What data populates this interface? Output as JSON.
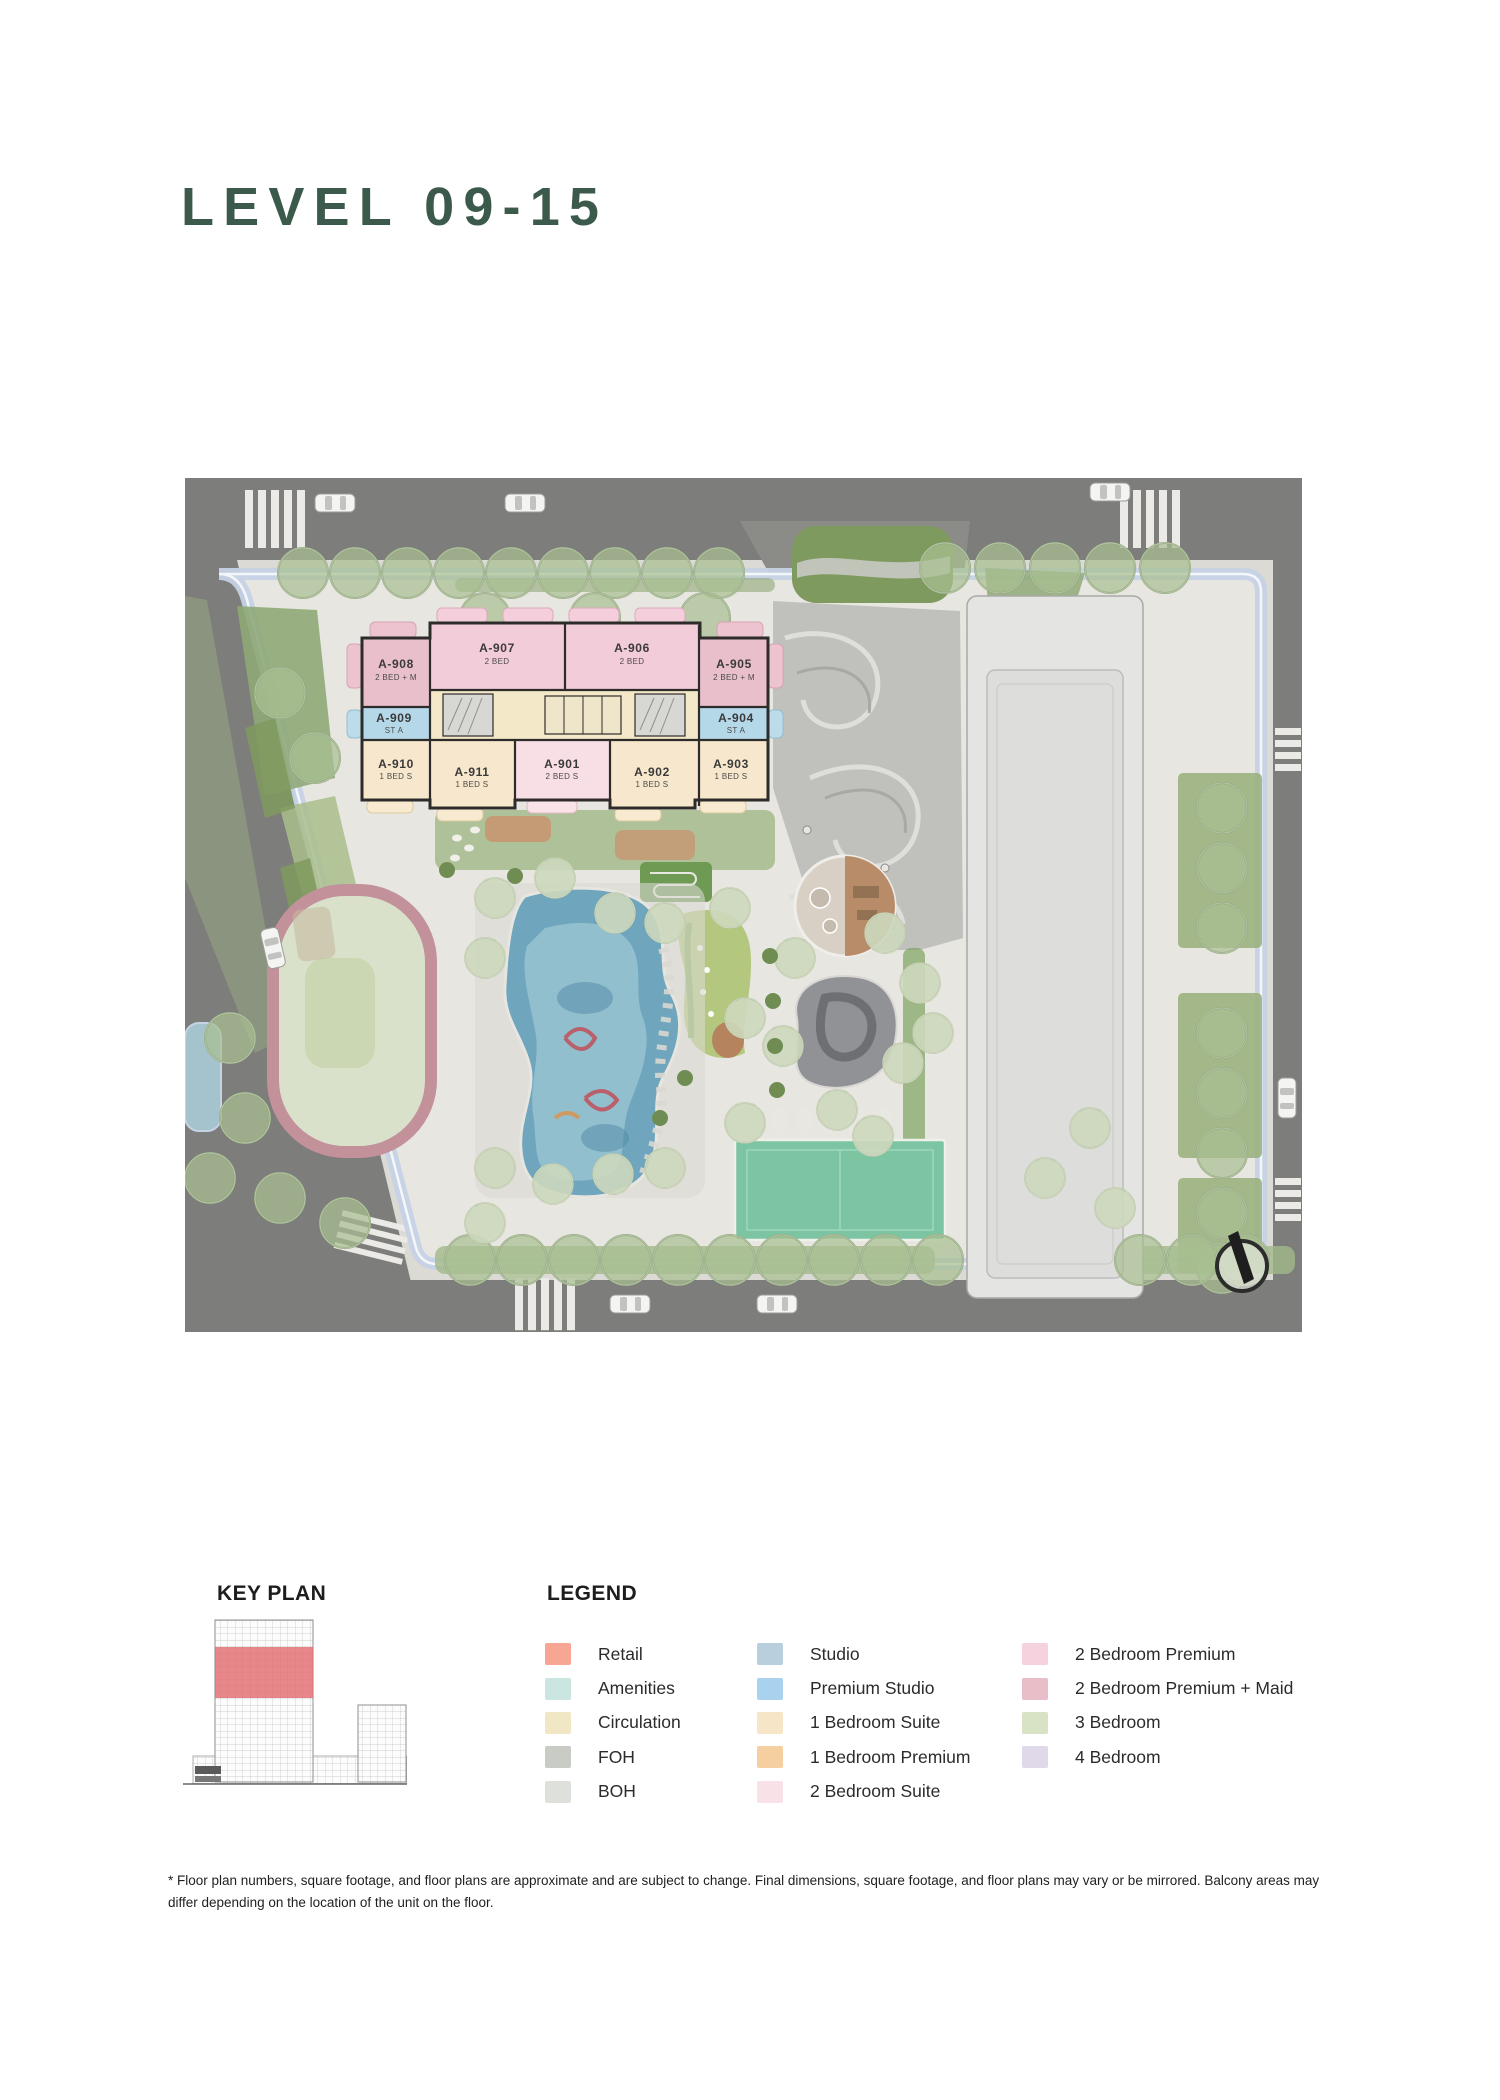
{
  "title": "LEVEL 09-15",
  "key_plan": {
    "title": "KEY PLAN",
    "highlight_color": "#E2696E"
  },
  "legend": {
    "title": "LEGEND",
    "columns": [
      {
        "items": [
          {
            "label": "Retail",
            "color": "#F6A693"
          },
          {
            "label": "Amenities",
            "color": "#CBE5E0"
          },
          {
            "label": "Circulation",
            "color": "#F1E7C5"
          },
          {
            "label": "FOH",
            "color": "#C9CBC5"
          },
          {
            "label": "BOH",
            "color": "#DEE0DB"
          }
        ]
      },
      {
        "items": [
          {
            "label": "Studio",
            "color": "#B9CFDE"
          },
          {
            "label": "Premium Studio",
            "color": "#A9D2EE"
          },
          {
            "label": "1 Bedroom Suite",
            "color": "#F7E5C8"
          },
          {
            "label": "1 Bedroom Premium",
            "color": "#F6CFA0"
          },
          {
            "label": "2 Bedroom Suite",
            "color": "#F9E2E7"
          }
        ]
      },
      {
        "items": [
          {
            "label": "2 Bedroom Premium",
            "color": "#F5D2DD"
          },
          {
            "label": "2 Bedroom Premium + Maid",
            "color": "#E9BEC9"
          },
          {
            "label": "3 Bedroom",
            "color": "#D8E2C4"
          },
          {
            "label": "4 Bedroom",
            "color": "#DFD9E9"
          }
        ]
      }
    ]
  },
  "plan": {
    "units": [
      {
        "id": "A-908",
        "sub": "2 BED + M"
      },
      {
        "id": "A-907",
        "sub": "2 BED"
      },
      {
        "id": "A-906",
        "sub": "2 BED"
      },
      {
        "id": "A-905",
        "sub": "2 BED + M"
      },
      {
        "id": "A-909",
        "sub": "ST A"
      },
      {
        "id": "A-904",
        "sub": "ST A"
      },
      {
        "id": "A-910",
        "sub": "1 BED S"
      },
      {
        "id": "A-911",
        "sub": "1 BED S"
      },
      {
        "id": "A-901",
        "sub": "2 BED S"
      },
      {
        "id": "A-902",
        "sub": "1 BED S"
      },
      {
        "id": "A-903",
        "sub": "1 BED S"
      }
    ],
    "unit_colors": {
      "premium_maid": "#E9BFCB",
      "premium": "#F3CCD9",
      "studio": "#B5D8E8",
      "one_bed_suite": "#F7E8CD",
      "two_bed_suite": "#F8DFE5",
      "circulation": "#F3E9C8"
    }
  },
  "footnote": "* Floor plan numbers, square footage, and floor plans are approximate and are subject to change. Final dimensions, square footage, and floor plans may vary or be mirrored. Balcony areas may differ depending on the location of the unit on the floor."
}
